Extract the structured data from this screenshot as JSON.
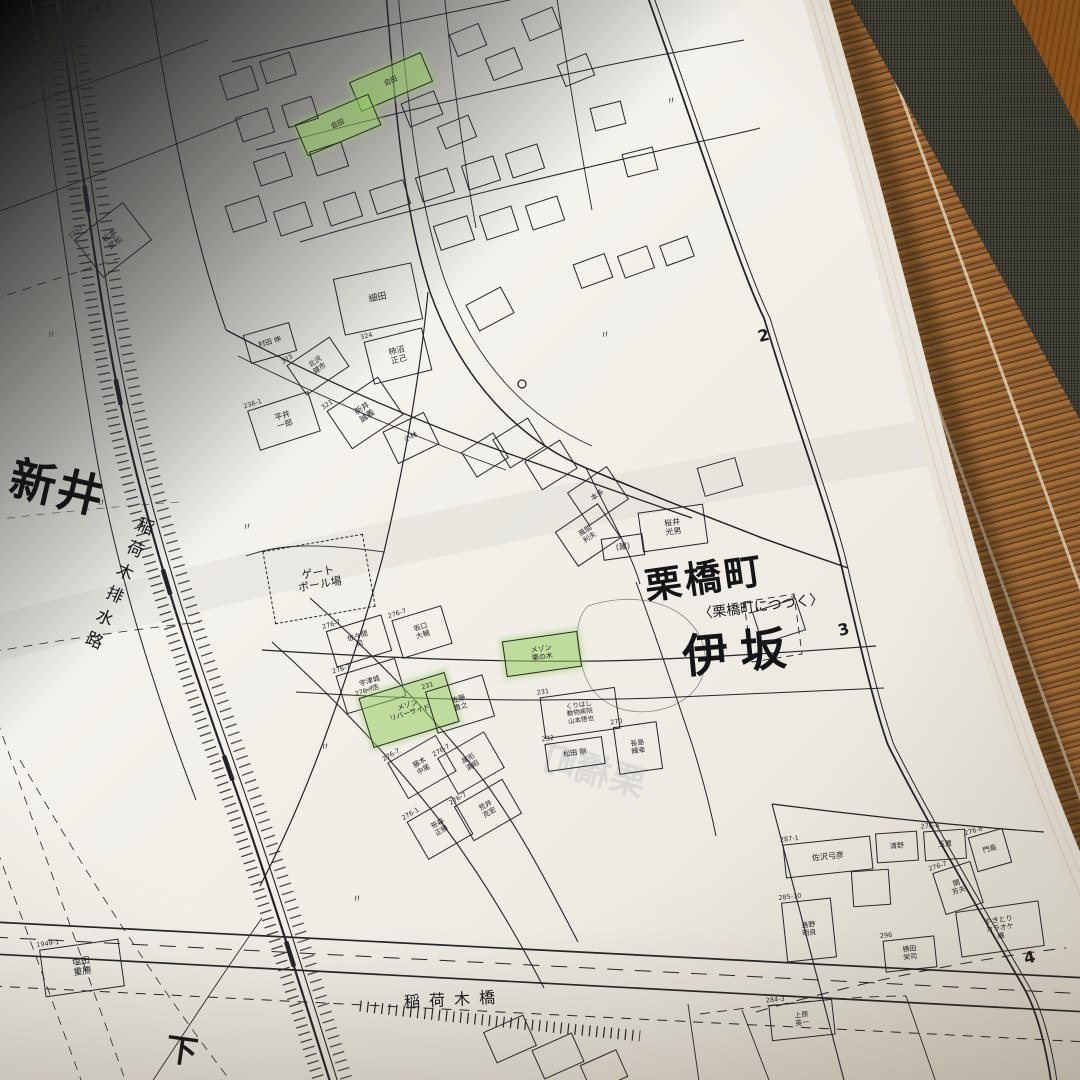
{
  "map": {
    "labels": {
      "arai": "新井",
      "canal": "稲荷木排水路",
      "bridge": "稲荷木橋",
      "shimo": "下",
      "kurihashi_cho": "栗橋町",
      "continues": "〈栗橋町につづく〉",
      "isaka": "伊坂",
      "ghost_showthrough": "栗橋町"
    },
    "colors": {
      "highlight_green": "#96cd5f",
      "ink": "#1d1d20",
      "paper": "#f2efe9",
      "mat_brown": "#8a5a2c",
      "fabric_band": "#45453c",
      "wood": "#9a5c20"
    },
    "grid_numbers": [
      {
        "label": "2",
        "x": 758,
        "y": 326
      },
      {
        "label": "3",
        "x": 838,
        "y": 620
      },
      {
        "label": "4",
        "x": 1024,
        "y": 948
      }
    ],
    "marks": [
      {
        "t": "〃",
        "x": 46,
        "y": 326
      },
      {
        "t": "〃",
        "x": 96,
        "y": 494
      },
      {
        "t": "〃",
        "x": 242,
        "y": 518
      },
      {
        "t": "〃",
        "x": 320,
        "y": 738
      },
      {
        "t": "〃",
        "x": 352,
        "y": 890
      },
      {
        "t": "〃",
        "x": 600,
        "y": 326
      },
      {
        "t": "〃",
        "x": 666,
        "y": 92
      }
    ],
    "buildings": [
      {
        "x": 78,
        "y": 2,
        "w": 30,
        "h": 16,
        "rot": -18,
        "label": "大塚",
        "fs": 7
      },
      {
        "x": 82,
        "y": 216,
        "w": 60,
        "h": 46,
        "rot": -38,
        "label": "松本\n武松",
        "num": "2233",
        "fs": 8
      },
      {
        "x": 338,
        "y": 270,
        "w": 78,
        "h": 56,
        "rot": -12,
        "label": "細田",
        "fs": 9
      },
      {
        "x": 352,
        "y": 66,
        "w": 76,
        "h": 30,
        "rot": -23,
        "label": "会田",
        "green": true,
        "fs": 7
      },
      {
        "x": 298,
        "y": 108,
        "w": 78,
        "h": 32,
        "rot": -23,
        "label": "会田",
        "green": true,
        "fs": 7
      },
      {
        "x": 246,
        "y": 328,
        "w": 46,
        "h": 28,
        "rot": -16,
        "label": "村田 伸",
        "fs": 7
      },
      {
        "x": 292,
        "y": 348,
        "w": 50,
        "h": 34,
        "rot": -34,
        "label": "北沢\n健市",
        "num": "323",
        "fs": 7
      },
      {
        "x": 368,
        "y": 334,
        "w": 58,
        "h": 42,
        "rot": -14,
        "label": "柿沼\n正己",
        "num": "324",
        "fs": 8
      },
      {
        "x": 334,
        "y": 390,
        "w": 60,
        "h": 44,
        "rot": -34,
        "label": "新井\n誠義",
        "num": "321",
        "fs": 8
      },
      {
        "x": 252,
        "y": 400,
        "w": 62,
        "h": 40,
        "rot": -18,
        "label": "平井\n一郎",
        "num": "236-1",
        "fs": 8
      },
      {
        "x": 388,
        "y": 420,
        "w": 44,
        "h": 34,
        "rot": -26,
        "label": "小林",
        "fs": 7
      },
      {
        "x": 574,
        "y": 476,
        "w": 46,
        "h": 38,
        "rot": -34,
        "label": "本多",
        "fs": 7
      },
      {
        "x": 562,
        "y": 514,
        "w": 50,
        "h": 40,
        "rot": -34,
        "label": "風間\n利夫",
        "fs": 7
      },
      {
        "x": 640,
        "y": 508,
        "w": 64,
        "h": 38,
        "rot": -8,
        "label": "桜井\n光男",
        "fs": 8
      },
      {
        "x": 602,
        "y": 536,
        "w": 40,
        "h": 20,
        "rot": -8,
        "label": "(建)",
        "fs": 8
      },
      {
        "x": 268,
        "y": 542,
        "w": 100,
        "h": 72,
        "rot": -10,
        "label": "ゲート\nボール場",
        "dashed": true,
        "fs": 11
      },
      {
        "x": 330,
        "y": 622,
        "w": 56,
        "h": 36,
        "rot": -17,
        "label": "佐々間\n司",
        "num": "276-7",
        "fs": 7
      },
      {
        "x": 396,
        "y": 612,
        "w": 50,
        "h": 38,
        "rot": -17,
        "label": "坂口\n大輔",
        "num": "276-7",
        "fs": 7
      },
      {
        "x": 340,
        "y": 666,
        "w": 60,
        "h": 38,
        "rot": -17,
        "label": "宇津城\n一浩",
        "num": "276-7",
        "fs": 7
      },
      {
        "x": 364,
        "y": 684,
        "w": 88,
        "h": 50,
        "rot": -17,
        "label": "メゾン\nリバーサイド",
        "num": "276-7",
        "green": true,
        "fs": 7
      },
      {
        "x": 430,
        "y": 682,
        "w": 58,
        "h": 42,
        "rot": -17,
        "label": "佐藤\n貴之",
        "num": "231",
        "fs": 7
      },
      {
        "x": 394,
        "y": 746,
        "w": 54,
        "h": 40,
        "rot": -30,
        "label": "藤木\n中尾",
        "num": "276-7",
        "fs": 7
      },
      {
        "x": 444,
        "y": 742,
        "w": 52,
        "h": 40,
        "rot": -30,
        "label": "尾形\n清昭",
        "num": "276-7",
        "fs": 7
      },
      {
        "x": 460,
        "y": 790,
        "w": 54,
        "h": 38,
        "rot": -30,
        "label": "荒井\n克宏",
        "num": "276-7",
        "fs": 7
      },
      {
        "x": 414,
        "y": 806,
        "w": 50,
        "h": 42,
        "rot": -30,
        "label": "笹森\n正勝",
        "num": "276-1",
        "fs": 7
      },
      {
        "x": 504,
        "y": 636,
        "w": 74,
        "h": 34,
        "rot": -8,
        "label": "メゾン\n栗の木",
        "green": true,
        "fs": 7
      },
      {
        "x": 542,
        "y": 692,
        "w": 74,
        "h": 40,
        "rot": -8,
        "label": "くりはし\n動物病院\n山本悟也",
        "num": "231",
        "fs": 6.5
      },
      {
        "x": 546,
        "y": 740,
        "w": 56,
        "h": 26,
        "rot": -8,
        "label": "松田 剛",
        "num": "232",
        "fs": 7
      },
      {
        "x": 616,
        "y": 724,
        "w": 42,
        "h": 46,
        "rot": -8,
        "label": "長島\n輝幸",
        "num": "270",
        "fs": 7
      },
      {
        "x": 784,
        "y": 840,
        "w": 86,
        "h": 32,
        "rot": -6,
        "label": "佐沢弓彦",
        "num": "287-1",
        "fs": 8
      },
      {
        "x": 852,
        "y": 870,
        "w": 36,
        "h": 34,
        "rot": -4,
        "label": ""
      },
      {
        "x": 876,
        "y": 832,
        "w": 40,
        "h": 28,
        "rot": -4,
        "label": "清野",
        "fs": 7
      },
      {
        "x": 924,
        "y": 830,
        "w": 40,
        "h": 28,
        "rot": -4,
        "label": "玉置",
        "num": "276-6",
        "fs": 7
      },
      {
        "x": 972,
        "y": 832,
        "w": 34,
        "h": 34,
        "rot": -16,
        "label": "門島",
        "num": "276-8",
        "fs": 7
      },
      {
        "x": 938,
        "y": 866,
        "w": 38,
        "h": 42,
        "rot": -18,
        "label": "関\n芳夫",
        "num": "276-7",
        "fs": 7
      },
      {
        "x": 958,
        "y": 906,
        "w": 82,
        "h": 44,
        "rot": -8,
        "label": "やきとり\nカラオケ\n磯",
        "fs": 7
      },
      {
        "x": 884,
        "y": 938,
        "w": 50,
        "h": 30,
        "rot": -6,
        "label": "横田\n栄司",
        "num": "296",
        "fs": 7
      },
      {
        "x": 784,
        "y": 900,
        "w": 48,
        "h": 58,
        "rot": -6,
        "label": "島野\n明良",
        "num": "285-10",
        "fs": 7
      },
      {
        "x": 770,
        "y": 1002,
        "w": 62,
        "h": 34,
        "rot": -6,
        "label": "上原\n英一",
        "num": "284-3",
        "fs": 7
      },
      {
        "x": 42,
        "y": 944,
        "w": 78,
        "h": 46,
        "rot": -8,
        "label": "塩田\n重勝",
        "num": "1949-1",
        "fs": 9
      },
      {
        "x": 222,
        "y": 70,
        "w": 32,
        "h": 24,
        "rot": -18,
        "label": ""
      },
      {
        "x": 262,
        "y": 56,
        "w": 30,
        "h": 22,
        "rot": -18,
        "label": ""
      },
      {
        "x": 238,
        "y": 112,
        "w": 32,
        "h": 24,
        "rot": -18,
        "label": ""
      },
      {
        "x": 284,
        "y": 100,
        "w": 30,
        "h": 22,
        "rot": -18,
        "label": ""
      },
      {
        "x": 256,
        "y": 156,
        "w": 32,
        "h": 24,
        "rot": -18,
        "label": ""
      },
      {
        "x": 312,
        "y": 146,
        "w": 32,
        "h": 24,
        "rot": -18,
        "label": ""
      },
      {
        "x": 228,
        "y": 200,
        "w": 34,
        "h": 26,
        "rot": -18,
        "label": ""
      },
      {
        "x": 276,
        "y": 206,
        "w": 32,
        "h": 24,
        "rot": -18,
        "label": ""
      },
      {
        "x": 326,
        "y": 196,
        "w": 32,
        "h": 24,
        "rot": -18,
        "label": ""
      },
      {
        "x": 372,
        "y": 184,
        "w": 34,
        "h": 24,
        "rot": -18,
        "label": ""
      },
      {
        "x": 418,
        "y": 172,
        "w": 32,
        "h": 24,
        "rot": -18,
        "label": ""
      },
      {
        "x": 464,
        "y": 160,
        "w": 32,
        "h": 24,
        "rot": -18,
        "label": ""
      },
      {
        "x": 508,
        "y": 148,
        "w": 32,
        "h": 24,
        "rot": -18,
        "label": ""
      },
      {
        "x": 436,
        "y": 220,
        "w": 34,
        "h": 24,
        "rot": -18,
        "label": ""
      },
      {
        "x": 482,
        "y": 210,
        "w": 32,
        "h": 24,
        "rot": -18,
        "label": ""
      },
      {
        "x": 528,
        "y": 200,
        "w": 32,
        "h": 24,
        "rot": -18,
        "label": ""
      },
      {
        "x": 452,
        "y": 28,
        "w": 30,
        "h": 22,
        "rot": -22,
        "label": ""
      },
      {
        "x": 488,
        "y": 52,
        "w": 30,
        "h": 22,
        "rot": -22,
        "label": ""
      },
      {
        "x": 524,
        "y": 12,
        "w": 32,
        "h": 22,
        "rot": -22,
        "label": ""
      },
      {
        "x": 560,
        "y": 58,
        "w": 30,
        "h": 22,
        "rot": -22,
        "label": ""
      },
      {
        "x": 592,
        "y": 104,
        "w": 30,
        "h": 22,
        "rot": -14,
        "label": ""
      },
      {
        "x": 624,
        "y": 150,
        "w": 30,
        "h": 22,
        "rot": -14,
        "label": ""
      },
      {
        "x": 576,
        "y": 258,
        "w": 32,
        "h": 24,
        "rot": -20,
        "label": ""
      },
      {
        "x": 620,
        "y": 250,
        "w": 30,
        "h": 22,
        "rot": -20,
        "label": ""
      },
      {
        "x": 662,
        "y": 240,
        "w": 28,
        "h": 20,
        "rot": -20,
        "label": ""
      },
      {
        "x": 470,
        "y": 294,
        "w": 38,
        "h": 28,
        "rot": -28,
        "label": ""
      },
      {
        "x": 498,
        "y": 426,
        "w": 40,
        "h": 32,
        "rot": -32,
        "label": ""
      },
      {
        "x": 530,
        "y": 448,
        "w": 40,
        "h": 32,
        "rot": -32,
        "label": ""
      },
      {
        "x": 466,
        "y": 440,
        "w": 36,
        "h": 28,
        "rot": -32,
        "label": ""
      },
      {
        "x": 488,
        "y": 1022,
        "w": 42,
        "h": 32,
        "rot": -24,
        "label": ""
      },
      {
        "x": 536,
        "y": 1040,
        "w": 42,
        "h": 30,
        "rot": -24,
        "label": ""
      },
      {
        "x": 584,
        "y": 1056,
        "w": 38,
        "h": 28,
        "rot": -24,
        "label": ""
      },
      {
        "x": 756,
        "y": 604,
        "w": 44,
        "h": 32,
        "rot": -18,
        "label": ""
      },
      {
        "x": 700,
        "y": 462,
        "w": 38,
        "h": 28,
        "rot": -16,
        "label": ""
      },
      {
        "x": 404,
        "y": 96,
        "w": 34,
        "h": 24,
        "rot": -22,
        "label": ""
      },
      {
        "x": 440,
        "y": 120,
        "w": 32,
        "h": 22,
        "rot": -22,
        "label": ""
      }
    ]
  }
}
